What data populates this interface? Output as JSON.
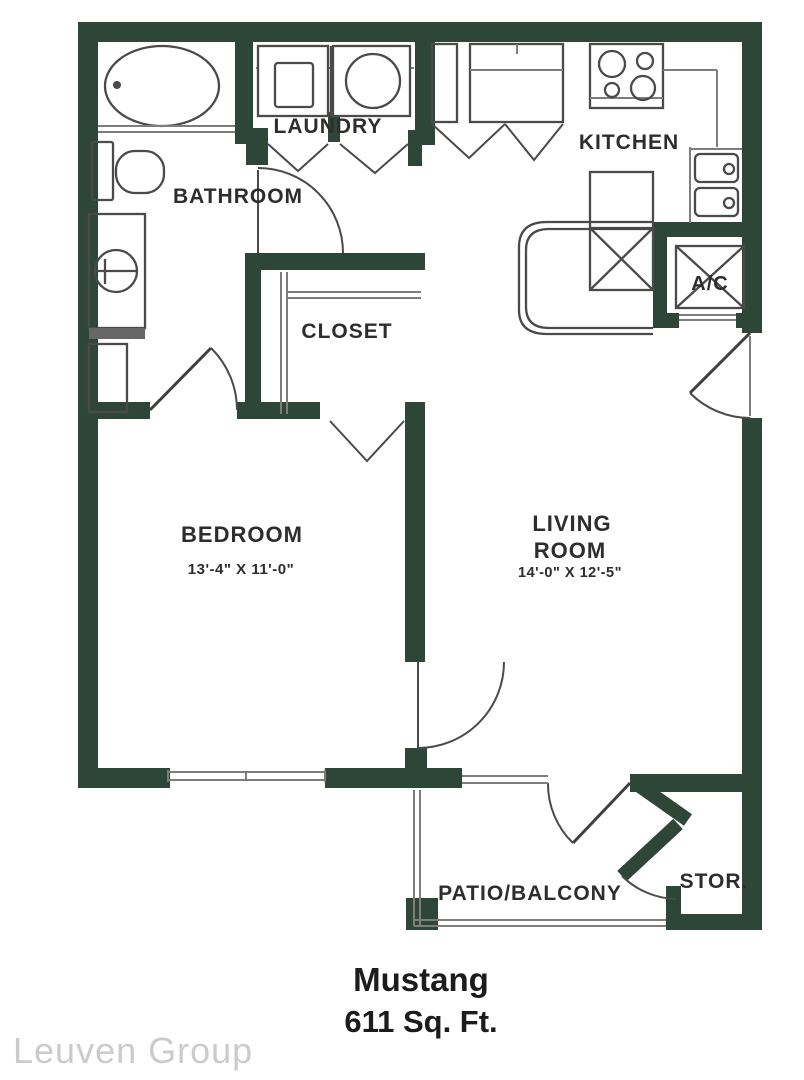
{
  "plan": {
    "title": "Mustang",
    "area": "611 Sq. Ft.",
    "watermark": "Leuven Group"
  },
  "rooms": {
    "laundry": {
      "label": "LAUNDRY"
    },
    "bathroom": {
      "label": "BATHROOM"
    },
    "kitchen": {
      "label": "KITCHEN"
    },
    "closet": {
      "label": "CLOSET"
    },
    "bedroom": {
      "label": "BEDROOM",
      "dimensions": "13'-4\" X 11'-0\""
    },
    "living": {
      "label_line1": "LIVING",
      "label_line2": "ROOM",
      "dimensions": "14'-0\" X 12'-5\""
    },
    "ac": {
      "label": "A/C"
    },
    "patio": {
      "label": "PATIO/BALCONY"
    },
    "storage": {
      "label": "STOR."
    }
  },
  "colors": {
    "wall": "#2e4638",
    "fixture_line": "#4a4a4a",
    "label_text": "#2d2d2d",
    "title_text": "#1c1c1c",
    "watermark_text": "#cbcbcb"
  }
}
